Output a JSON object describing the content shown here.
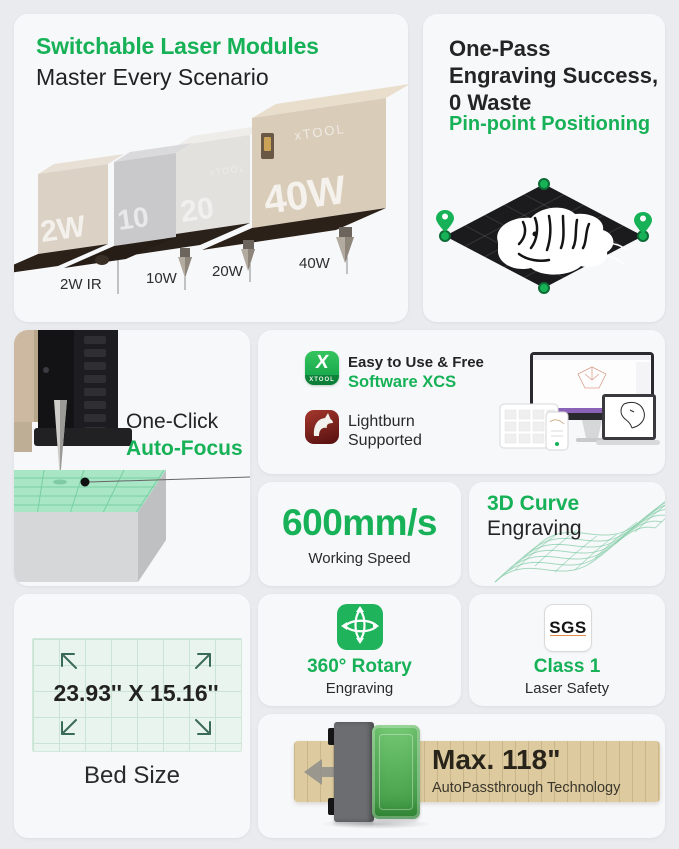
{
  "theme": {
    "background": "#e9ebee",
    "card": "#f7f8fa",
    "green": "#17b157",
    "dark": "#1f1f1f"
  },
  "cards": {
    "modules": {
      "title": "Switchable Laser Modules",
      "subtitle": "Master Every Scenario",
      "brand": "xTOOL",
      "items": [
        {
          "face_label": "2W",
          "callout": "2W IR"
        },
        {
          "face_label": "10",
          "callout": "10W"
        },
        {
          "face_label": "20",
          "callout": "20W"
        },
        {
          "face_label": "40W",
          "callout": "40W"
        }
      ]
    },
    "onepass": {
      "title_line1": "One-Pass",
      "title_line2": "Engraving Success,",
      "title_line3": "0 Waste",
      "highlight": "Pin-point Positioning"
    },
    "autofocus": {
      "line1": "One-Click",
      "line2": "Auto-Focus"
    },
    "software": {
      "xcs_icon_letter": "X",
      "xcs_icon_brand": "XTOOL",
      "line1": "Easy to Use & Free",
      "line2": "Software XCS",
      "lightburn_line1": "Lightburn",
      "lightburn_line2": "Supported"
    },
    "speed": {
      "value": "600mm/s",
      "label": "Working Speed"
    },
    "curve": {
      "title": "3D Curve",
      "subtitle": "Engraving"
    },
    "bed": {
      "dimensions": "23.93'' X 15.16''",
      "label": "Bed Size"
    },
    "rotary": {
      "title": "360° Rotary",
      "subtitle": "Engraving"
    },
    "safety": {
      "badge": "SGS",
      "title": "Class 1",
      "subtitle": "Laser Safety"
    },
    "passthrough": {
      "title": "Max. 118\"",
      "subtitle": "AutoPassthrough Technology"
    }
  }
}
